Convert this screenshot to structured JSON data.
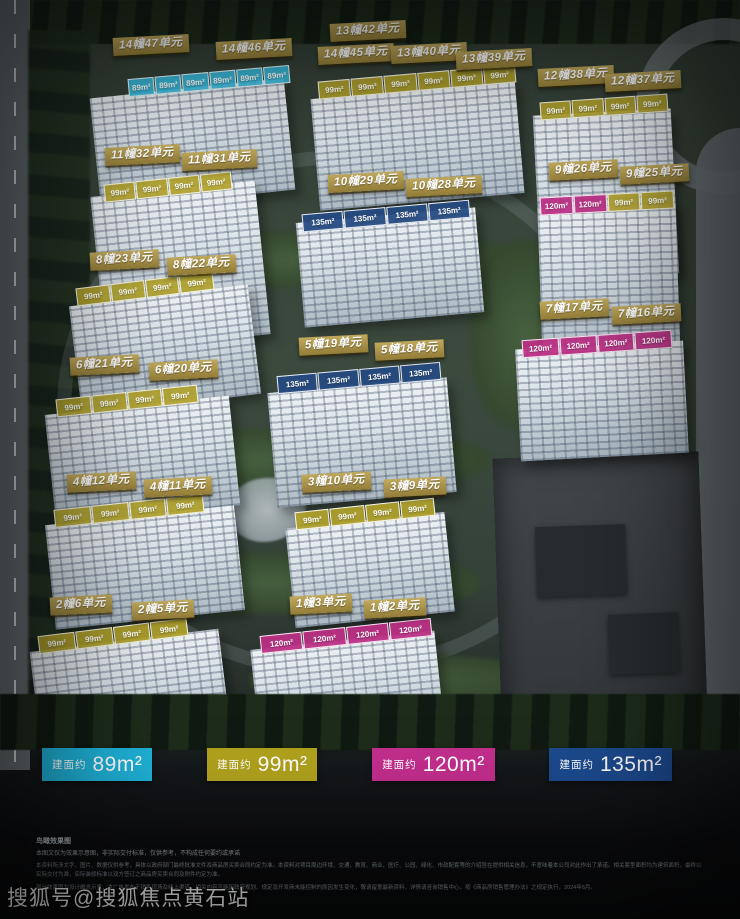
{
  "watermark": "搜狐号@搜狐焦点黄石站",
  "legend": {
    "prefix": "建面约",
    "items": [
      {
        "area": "89m²",
        "color": "#1fb2d8"
      },
      {
        "area": "99m²",
        "color": "#b0a11d"
      },
      {
        "area": "120m²",
        "color": "#c12e8c"
      },
      {
        "area": "135m²",
        "color": "#1c4a8e"
      }
    ]
  },
  "colors": {
    "unit_cyan": "#38bde0",
    "unit_yellow": "#b2a32d",
    "unit_navy": "#264a82",
    "unit_magenta": "#bc3085",
    "plaque_gold": "#a8914a"
  },
  "buildings": [
    {
      "labels": [
        "14幢47单元",
        "14幢46单元",
        "14幢45单元"
      ],
      "units": [
        "89m²",
        "89m²",
        "89m²",
        "89m²",
        "89m²",
        "89m²"
      ],
      "type": "cyan"
    },
    {
      "labels": [
        "13幢42单元",
        "13幢40单元",
        "13幢39单元"
      ],
      "units": [
        "99m²",
        "99m²",
        "99m²",
        "99m²",
        "99m²",
        "99m²"
      ],
      "type": "yellow"
    },
    {
      "labels": [
        "12幢38单元",
        "12幢37单元"
      ],
      "units": [
        "99m²",
        "99m²",
        "99m²",
        "99m²"
      ],
      "type": "yellow"
    },
    {
      "labels": [
        "11幢32单元",
        "11幢31单元"
      ],
      "units": [
        "99m²",
        "99m²",
        "99m²",
        "99m²"
      ],
      "type": "yellow"
    },
    {
      "labels": [
        "10幢29单元",
        "10幢28单元"
      ],
      "units": [
        "135m²",
        "135m²",
        "135m²",
        "135m²"
      ],
      "type": "navy"
    },
    {
      "labels": [
        "9幢26单元",
        "9幢25单元"
      ],
      "units": [
        "120m²",
        "120m²",
        "99m²",
        "99m²"
      ],
      "type": "mixed"
    },
    {
      "labels": [
        "8幢23单元",
        "8幢22单元"
      ],
      "units": [
        "99m²",
        "99m²",
        "99m²",
        "99m²"
      ],
      "type": "yellow"
    },
    {
      "labels": [
        "7幢17单元",
        "7幢16单元"
      ],
      "units": [
        "120m²",
        "120m²",
        "120m²",
        "120m²"
      ],
      "type": "magenta"
    },
    {
      "labels": [
        "6幢21单元",
        "6幢20单元"
      ],
      "units": [
        "99m²",
        "99m²",
        "99m²",
        "99m²"
      ],
      "type": "yellow"
    },
    {
      "labels": [
        "5幢19单元",
        "5幢18单元"
      ],
      "units": [
        "135m²",
        "135m²",
        "135m²",
        "135m²"
      ],
      "type": "navy"
    },
    {
      "labels": [
        "4幢12单元",
        "4幢11单元"
      ],
      "units": [
        "99m²",
        "99m²",
        "99m²",
        "99m²"
      ],
      "type": "yellow"
    },
    {
      "labels": [
        "3幢10单元",
        "3幢9单元"
      ],
      "units": [
        "99m²",
        "99m²",
        "99m²",
        "99m²"
      ],
      "type": "yellow"
    },
    {
      "labels": [
        "2幢6单元",
        "2幢5单元"
      ],
      "units": [
        "99m²",
        "99m²",
        "99m²",
        "99m²"
      ],
      "type": "yellow"
    },
    {
      "labels": [
        "1幢3单元",
        "1幢2单元"
      ],
      "units": [
        "120m²",
        "120m²",
        "120m²",
        "120m²"
      ],
      "type": "magenta"
    }
  ],
  "footnote": {
    "title": "鸟瞰效果图",
    "line1": "本图文仅为效果示意图，非实际交付标准，仅供参考，不构成任何要约或承诺",
    "para1": "本资料所涉文字、图片、数据仅供参考，具体以政府部门最终批准文件及商品房买卖合同约定为准。本资料对项目周边环境、交通、教育、商业、医疗、公园、绿化、市政配套等的介绍旨在提供相关信息，不意味着本公司对此作出了承诺。相关套型面积均为建筑面积，最终以实际交付为准，实际装修标准以双方签订之商品房买卖合同及附件约定为准。",
    "para2": "部分效果图为设计概念示意，本广告发布于销售现场及线上渠道，相关内容可能因政府规划、规定及开发商未能控制的原因发生变化，敬请留意最新资料，详情请咨询销售中心，按《商品房销售管理办法》之规定执行，2024年6月。"
  }
}
